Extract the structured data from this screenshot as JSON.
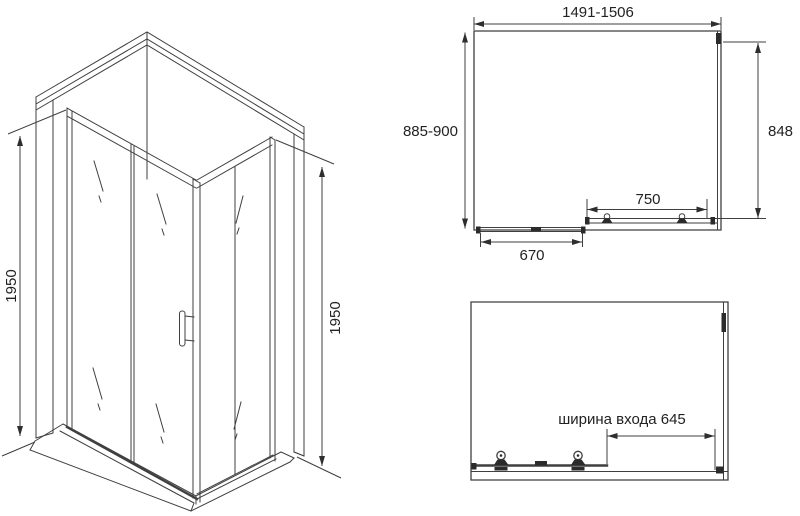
{
  "drawing": {
    "subject": "corner shower enclosure technical dimension drawing",
    "colors": {
      "line": "#3f3f3f",
      "fill_detail": "#2b2b2b",
      "text": "#222222",
      "background": "#ffffff"
    },
    "iso_view": {
      "height_left": "1950",
      "height_right": "1950"
    },
    "plan_view": {
      "overall_width": "1491-1506",
      "overall_depth": "885-900",
      "side_panel": "848",
      "door_span": "750",
      "track_span": "670"
    },
    "front_view": {
      "entry_width": "ширина входа 645"
    }
  }
}
